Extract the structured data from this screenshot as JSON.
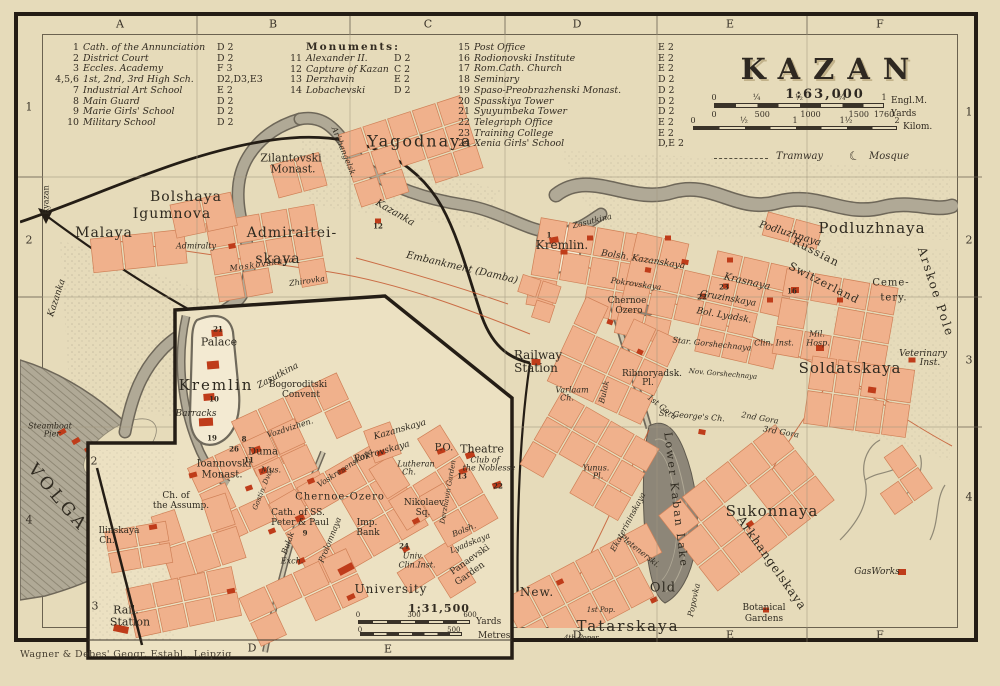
{
  "frame": {
    "attribution": "Wagner & Debes' Geogr. Establ., Leipzig"
  },
  "title_block": {
    "title": "KAZAN",
    "scale": "1:63,000",
    "miles": {
      "ticks": [
        "0",
        "¼",
        "½",
        "¾",
        "1"
      ],
      "unit": "Engl.M."
    },
    "yards": {
      "ticks": [
        "0",
        "500",
        "1000",
        "1500",
        "1760"
      ],
      "unit": "Yards"
    },
    "kilometres": {
      "ticks": [
        "0",
        "½",
        "1",
        "1½",
        "2"
      ],
      "unit": "Kilom."
    },
    "symbols": {
      "tramway": "Tramway",
      "mosque": "Mosque"
    }
  },
  "legend": {
    "columns": [
      {
        "header": "",
        "rows": [
          {
            "no": "1",
            "name": "Cath. of the Annunciation",
            "ref": "D 2"
          },
          {
            "no": "2",
            "name": "District Court",
            "ref": "D 2"
          },
          {
            "no": "3",
            "name": "Eccles. Academy",
            "ref": "F 3"
          },
          {
            "no": "4,5,6",
            "name": "1st, 2nd, 3rd High Sch.",
            "ref": "D2,D3,E3"
          },
          {
            "no": "7",
            "name": "Industrial Art School",
            "ref": "E 2"
          },
          {
            "no": "8",
            "name": "Main Guard",
            "ref": "D 2"
          },
          {
            "no": "9",
            "name": "Marie Girls' School",
            "ref": "D 2"
          },
          {
            "no": "10",
            "name": "Military School",
            "ref": "D 2"
          }
        ]
      },
      {
        "header": "Monuments:",
        "rows": [
          {
            "no": "11",
            "name": "Alexander II.",
            "ref": "D 2"
          },
          {
            "no": "12",
            "name": "Capture of Kazan",
            "ref": "C 2"
          },
          {
            "no": "13",
            "name": "Derzhavin",
            "ref": "E 2"
          },
          {
            "no": "14",
            "name": "Lobachevski",
            "ref": "D 2"
          }
        ]
      },
      {
        "header": "",
        "rows": [
          {
            "no": "15",
            "name": "Post Office",
            "ref": "E 2"
          },
          {
            "no": "16",
            "name": "Rodionovski Institute",
            "ref": "E 2"
          },
          {
            "no": "17",
            "name": "Rom.Cath. Church",
            "ref": "E 2"
          },
          {
            "no": "18",
            "name": "Seminary",
            "ref": "D 2"
          },
          {
            "no": "19",
            "name": "Spaso-Preobrazhenski Monast.",
            "ref": "D 2"
          },
          {
            "no": "20",
            "name": "Spasskiya Tower",
            "ref": "D 2"
          },
          {
            "no": "21",
            "name": "Syuyumbeka Tower",
            "ref": "D 2"
          },
          {
            "no": "22",
            "name": "Telegraph Office",
            "ref": "E 2"
          },
          {
            "no": "23",
            "name": "Training College",
            "ref": "E 2"
          },
          {
            "no": "24",
            "name": "Xenia Girls' School",
            "ref": "D,E 2"
          }
        ]
      }
    ]
  },
  "grid": {
    "top": [
      "A",
      "B",
      "C",
      "D",
      "E",
      "F"
    ],
    "bottom": [
      "D",
      "E",
      "F"
    ],
    "left": [
      "1",
      "2",
      "4"
    ],
    "right": [
      "1",
      "2",
      "3",
      "4"
    ]
  },
  "inset": {
    "scale": "1:31,500",
    "yards": {
      "ticks": [
        "0",
        "300",
        "600"
      ],
      "unit": "Yards"
    },
    "metres": {
      "ticks": [
        "0",
        "500"
      ],
      "unit": "Metres"
    },
    "grid_bottom": [
      "D",
      "E"
    ],
    "grid_left": [
      "2",
      "3"
    ]
  },
  "map_labels": [
    {
      "t": "Yagodnaya",
      "x": 420,
      "y": 141,
      "s": 16,
      "sp": 2
    },
    {
      "t": "Zilantovski",
      "x": 291,
      "y": 158,
      "s": 11
    },
    {
      "t": "Monast.",
      "x": 293,
      "y": 169,
      "s": 11
    },
    {
      "t": "Bolshaya",
      "x": 186,
      "y": 197,
      "s": 14,
      "sp": 1
    },
    {
      "t": "Igumnova",
      "x": 172,
      "y": 214,
      "s": 14,
      "sp": 1
    },
    {
      "t": "Malaya",
      "x": 104,
      "y": 233,
      "s": 14,
      "sp": 1
    },
    {
      "t": "Admiralty",
      "x": 196,
      "y": 246,
      "s": 8,
      "i": 1
    },
    {
      "t": "Admiraltei-",
      "x": 292,
      "y": 233,
      "s": 14,
      "sp": 1
    },
    {
      "t": "skaya",
      "x": 278,
      "y": 259,
      "s": 14,
      "sp": 1
    },
    {
      "t": "Zhirovka",
      "x": 307,
      "y": 281,
      "s": 8,
      "i": 1,
      "r": -8
    },
    {
      "t": "Moskovskaya",
      "x": 262,
      "y": 264,
      "s": 8,
      "i": 1,
      "r": -8,
      "sp": 1
    },
    {
      "t": "Kazanka",
      "x": 57,
      "y": 298,
      "s": 9,
      "i": 1,
      "r": -72
    },
    {
      "t": "Kazanka",
      "x": 395,
      "y": 213,
      "s": 10,
      "i": 1,
      "r": 30
    },
    {
      "t": "Embankment (Damba)",
      "x": 462,
      "y": 268,
      "s": 10,
      "i": 1,
      "r": 13
    },
    {
      "t": "Ryazan",
      "x": 46,
      "y": 200,
      "s": 8,
      "r": -90
    },
    {
      "t": "Kremlin.",
      "x": 562,
      "y": 245,
      "s": 12
    },
    {
      "t": "1",
      "x": 549,
      "y": 235,
      "s": 7,
      "w": 1
    },
    {
      "t": "12",
      "x": 378,
      "y": 226,
      "s": 7,
      "w": 1
    },
    {
      "t": "Zasutkina",
      "x": 592,
      "y": 221,
      "s": 8,
      "i": 1,
      "r": -14
    },
    {
      "t": "Bolsh. Kazanskaya",
      "x": 643,
      "y": 260,
      "s": 9,
      "i": 1,
      "r": 9
    },
    {
      "t": "Krasnaya",
      "x": 747,
      "y": 282,
      "s": 10,
      "i": 1,
      "r": 13
    },
    {
      "t": "Pokrovskaya",
      "x": 636,
      "y": 284,
      "s": 8,
      "i": 1,
      "r": 8
    },
    {
      "t": "Chernoe",
      "x": 627,
      "y": 301,
      "s": 9
    },
    {
      "t": "Ozero",
      "x": 629,
      "y": 311,
      "s": 9
    },
    {
      "t": "Gruzinskaya",
      "x": 728,
      "y": 299,
      "s": 9,
      "i": 1,
      "r": 10
    },
    {
      "t": "Bol. Lyadsk.",
      "x": 724,
      "y": 316,
      "s": 9,
      "i": 1,
      "r": 10
    },
    {
      "t": "16",
      "x": 792,
      "y": 291,
      "s": 7,
      "w": 1
    },
    {
      "t": "23",
      "x": 724,
      "y": 287,
      "s": 7,
      "w": 1
    },
    {
      "t": "22",
      "x": 702,
      "y": 297,
      "s": 7,
      "w": 1
    },
    {
      "t": "Podluzhnaya",
      "x": 790,
      "y": 234,
      "s": 10,
      "i": 1,
      "r": 17
    },
    {
      "t": "Podluzhnaya",
      "x": 872,
      "y": 228,
      "s": 15,
      "sp": 1
    },
    {
      "t": "Russian",
      "x": 816,
      "y": 252,
      "s": 11,
      "r": 27,
      "sp": 1
    },
    {
      "t": "Switzerland",
      "x": 824,
      "y": 283,
      "s": 11,
      "r": 27,
      "sp": 1
    },
    {
      "t": "Ceme-",
      "x": 891,
      "y": 283,
      "s": 10,
      "sp": 1
    },
    {
      "t": "tery.",
      "x": 894,
      "y": 298,
      "s": 10,
      "sp": 1
    },
    {
      "t": "Arskoe Pole",
      "x": 936,
      "y": 292,
      "s": 12,
      "r": 72,
      "sp": 2
    },
    {
      "t": "Mil.",
      "x": 817,
      "y": 334,
      "s": 8,
      "i": 1
    },
    {
      "t": "Hosp.",
      "x": 818,
      "y": 343,
      "s": 8,
      "i": 1
    },
    {
      "t": "Soldatskaya",
      "x": 850,
      "y": 368,
      "s": 15,
      "sp": 1
    },
    {
      "t": "Veterinary",
      "x": 923,
      "y": 354,
      "s": 9,
      "i": 1
    },
    {
      "t": "Inst.",
      "x": 930,
      "y": 363,
      "s": 9,
      "i": 1
    },
    {
      "t": "Railway",
      "x": 538,
      "y": 355,
      "s": 12
    },
    {
      "t": "Station",
      "x": 536,
      "y": 368,
      "s": 12
    },
    {
      "t": "Varlaam",
      "x": 572,
      "y": 390,
      "s": 8,
      "i": 1
    },
    {
      "t": "Ch.",
      "x": 567,
      "y": 398,
      "s": 8,
      "i": 1
    },
    {
      "t": "Ribnoryadsk.",
      "x": 652,
      "y": 374,
      "s": 9
    },
    {
      "t": "Pl.",
      "x": 648,
      "y": 383,
      "s": 9
    },
    {
      "t": "St. George's Ch.",
      "x": 692,
      "y": 416,
      "s": 8,
      "i": 1,
      "r": 5
    },
    {
      "t": "1st Gora",
      "x": 662,
      "y": 407,
      "s": 8,
      "i": 1,
      "r": 38
    },
    {
      "t": "2nd Gora",
      "x": 760,
      "y": 418,
      "s": 8,
      "i": 1,
      "r": 10
    },
    {
      "t": "3rd Gora",
      "x": 781,
      "y": 432,
      "s": 8,
      "i": 1,
      "r": 10
    },
    {
      "t": "Star. Gorshechnaya",
      "x": 712,
      "y": 344,
      "s": 8,
      "i": 1,
      "r": 6
    },
    {
      "t": "Nov. Gorshechnaya",
      "x": 723,
      "y": 374,
      "s": 7,
      "i": 1,
      "r": 5
    },
    {
      "t": "Clin. Inst.",
      "x": 774,
      "y": 343,
      "s": 8,
      "i": 1
    },
    {
      "t": "Bulak",
      "x": 604,
      "y": 392,
      "s": 8,
      "i": 1,
      "r": -77
    },
    {
      "t": "Ekaterininskaya",
      "x": 628,
      "y": 522,
      "s": 8,
      "i": 1,
      "r": -62
    },
    {
      "t": "Lower Kaban Lake",
      "x": 676,
      "y": 500,
      "s": 11,
      "r": 83,
      "sp": 2
    },
    {
      "t": "Popovka",
      "x": 694,
      "y": 600,
      "s": 8,
      "i": 1,
      "r": -78
    },
    {
      "t": "Pletenerski.",
      "x": 640,
      "y": 551,
      "s": 8,
      "i": 1,
      "r": 38
    },
    {
      "t": "Yunus.",
      "x": 596,
      "y": 468,
      "s": 8,
      "i": 1
    },
    {
      "t": "Pl.",
      "x": 598,
      "y": 476,
      "s": 8,
      "i": 1
    },
    {
      "t": "Sukonnaya",
      "x": 772,
      "y": 511,
      "s": 15,
      "sp": 1
    },
    {
      "t": "Arkhangelskaya",
      "x": 772,
      "y": 563,
      "s": 12,
      "r": 55,
      "sp": 1
    },
    {
      "t": "GasWorks",
      "x": 877,
      "y": 572,
      "s": 9,
      "i": 1
    },
    {
      "t": "Botanical",
      "x": 764,
      "y": 608,
      "s": 9
    },
    {
      "t": "Gardens",
      "x": 764,
      "y": 619,
      "s": 9
    },
    {
      "t": "Old",
      "x": 663,
      "y": 588,
      "s": 13,
      "sp": 1
    },
    {
      "t": "New.",
      "x": 537,
      "y": 592,
      "s": 12,
      "sp": 1
    },
    {
      "t": "Tatarskaya",
      "x": 628,
      "y": 626,
      "s": 15,
      "sp": 2
    },
    {
      "t": "1st Pop.",
      "x": 601,
      "y": 610,
      "s": 7,
      "i": 1
    },
    {
      "t": "4th Poper.",
      "x": 582,
      "y": 638,
      "s": 7,
      "i": 1
    },
    {
      "t": "Steamboat",
      "x": 50,
      "y": 426,
      "s": 8,
      "i": 1
    },
    {
      "t": "Pier",
      "x": 52,
      "y": 434,
      "s": 8,
      "i": 1
    },
    {
      "t": "VOLGA",
      "x": 58,
      "y": 498,
      "s": 17,
      "r": 50,
      "sp": 4
    },
    {
      "t": "Arkhangelsk.",
      "x": 344,
      "y": 152,
      "s": 8,
      "i": 1,
      "r": 68
    },
    {
      "t": "21",
      "x": 218,
      "y": 329,
      "s": 7,
      "w": 1
    },
    {
      "t": "Palace",
      "x": 219,
      "y": 342,
      "s": 11
    },
    {
      "t": "Kremlin",
      "x": 216,
      "y": 385,
      "s": 15,
      "sp": 2
    },
    {
      "t": "10",
      "x": 214,
      "y": 399,
      "s": 7,
      "w": 1
    },
    {
      "t": "Barracks",
      "x": 196,
      "y": 414,
      "s": 9,
      "i": 1
    },
    {
      "t": "Zasutkina",
      "x": 278,
      "y": 376,
      "s": 9,
      "i": 1,
      "r": -28
    },
    {
      "t": "Bogoroditski",
      "x": 298,
      "y": 385,
      "s": 9
    },
    {
      "t": "Convent",
      "x": 301,
      "y": 395,
      "s": 9
    },
    {
      "t": "Vozdvizhen.",
      "x": 290,
      "y": 428,
      "s": 8,
      "i": 1,
      "r": -18
    },
    {
      "t": "19",
      "x": 212,
      "y": 438,
      "s": 7,
      "w": 1
    },
    {
      "t": "8",
      "x": 244,
      "y": 439,
      "s": 7,
      "w": 1
    },
    {
      "t": "26",
      "x": 234,
      "y": 449,
      "s": 7,
      "w": 1
    },
    {
      "t": "11",
      "x": 249,
      "y": 460,
      "s": 7,
      "w": 1
    },
    {
      "t": "Duma",
      "x": 263,
      "y": 452,
      "s": 10
    },
    {
      "t": "Mus.",
      "x": 271,
      "y": 470,
      "s": 8,
      "i": 1
    },
    {
      "t": "Ioannovski",
      "x": 224,
      "y": 464,
      "s": 10
    },
    {
      "t": "Monast.",
      "x": 222,
      "y": 475,
      "s": 10
    },
    {
      "t": "Gostin. Dvor",
      "x": 263,
      "y": 489,
      "s": 7,
      "i": 1,
      "r": -68
    },
    {
      "t": "Kazanskaya",
      "x": 400,
      "y": 430,
      "s": 9,
      "i": 1,
      "r": -16
    },
    {
      "t": "Pokrovskaya",
      "x": 382,
      "y": 452,
      "s": 9,
      "i": 1,
      "r": -16
    },
    {
      "t": "Voskresenskaya",
      "x": 345,
      "y": 468,
      "s": 8,
      "i": 1,
      "r": -33
    },
    {
      "t": "Prolomnaya",
      "x": 330,
      "y": 540,
      "s": 8,
      "i": 1,
      "r": -68
    },
    {
      "t": "Bulak",
      "x": 288,
      "y": 543,
      "s": 8,
      "i": 1,
      "r": -70
    },
    {
      "t": "Ch. of",
      "x": 176,
      "y": 496,
      "s": 9
    },
    {
      "t": "the Assump.",
      "x": 181,
      "y": 506,
      "s": 9
    },
    {
      "t": "Ilinskaya",
      "x": 119,
      "y": 531,
      "s": 9
    },
    {
      "t": "Ch.",
      "x": 107,
      "y": 541,
      "s": 9
    },
    {
      "t": "Cath. of SS.",
      "x": 298,
      "y": 513,
      "s": 9
    },
    {
      "t": "Peter & Paul",
      "x": 300,
      "y": 523,
      "s": 9
    },
    {
      "t": "9",
      "x": 305,
      "y": 533,
      "s": 7,
      "w": 1
    },
    {
      "t": "Exch.",
      "x": 292,
      "y": 561,
      "s": 8,
      "i": 1
    },
    {
      "t": "Lutheran",
      "x": 416,
      "y": 464,
      "s": 8,
      "i": 1
    },
    {
      "t": "Ch.",
      "x": 409,
      "y": 472,
      "s": 8,
      "i": 1
    },
    {
      "t": "P.O.",
      "x": 444,
      "y": 448,
      "s": 10
    },
    {
      "t": "Theatre",
      "x": 482,
      "y": 449,
      "s": 11
    },
    {
      "t": "Club of",
      "x": 485,
      "y": 460,
      "s": 8,
      "i": 1
    },
    {
      "t": "the Noblesse",
      "x": 489,
      "y": 468,
      "s": 8,
      "i": 1
    },
    {
      "t": "13",
      "x": 462,
      "y": 476,
      "s": 7,
      "w": 1
    },
    {
      "t": "22",
      "x": 498,
      "y": 486,
      "s": 7,
      "w": 1
    },
    {
      "t": "Derzhavin Garden",
      "x": 448,
      "y": 492,
      "s": 7,
      "i": 1,
      "r": -80
    },
    {
      "t": "Chernoe-Ozero",
      "x": 340,
      "y": 497,
      "s": 10,
      "sp": 1
    },
    {
      "t": "Nikolaev",
      "x": 424,
      "y": 503,
      "s": 9
    },
    {
      "t": "Sq.",
      "x": 423,
      "y": 513,
      "s": 9
    },
    {
      "t": "Imp.",
      "x": 367,
      "y": 523,
      "s": 9
    },
    {
      "t": "Bank",
      "x": 368,
      "y": 533,
      "s": 9
    },
    {
      "t": "24",
      "x": 404,
      "y": 546,
      "s": 7,
      "w": 1
    },
    {
      "t": "Univ.",
      "x": 413,
      "y": 556,
      "s": 8,
      "i": 1
    },
    {
      "t": "Clin.Inst.",
      "x": 417,
      "y": 565,
      "s": 8,
      "i": 1
    },
    {
      "t": "University",
      "x": 391,
      "y": 589,
      "s": 12,
      "sp": 1
    },
    {
      "t": "Panaevski",
      "x": 470,
      "y": 560,
      "s": 9,
      "r": -35
    },
    {
      "t": "Garden",
      "x": 470,
      "y": 574,
      "s": 9,
      "r": -35
    },
    {
      "t": "Bolsh.",
      "x": 464,
      "y": 530,
      "s": 8,
      "i": 1,
      "r": -22
    },
    {
      "t": "Lyadskaya",
      "x": 470,
      "y": 543,
      "s": 8,
      "i": 1,
      "r": -22
    },
    {
      "t": "Rail.",
      "x": 126,
      "y": 610,
      "s": 11
    },
    {
      "t": "Station",
      "x": 130,
      "y": 622,
      "s": 11
    }
  ]
}
